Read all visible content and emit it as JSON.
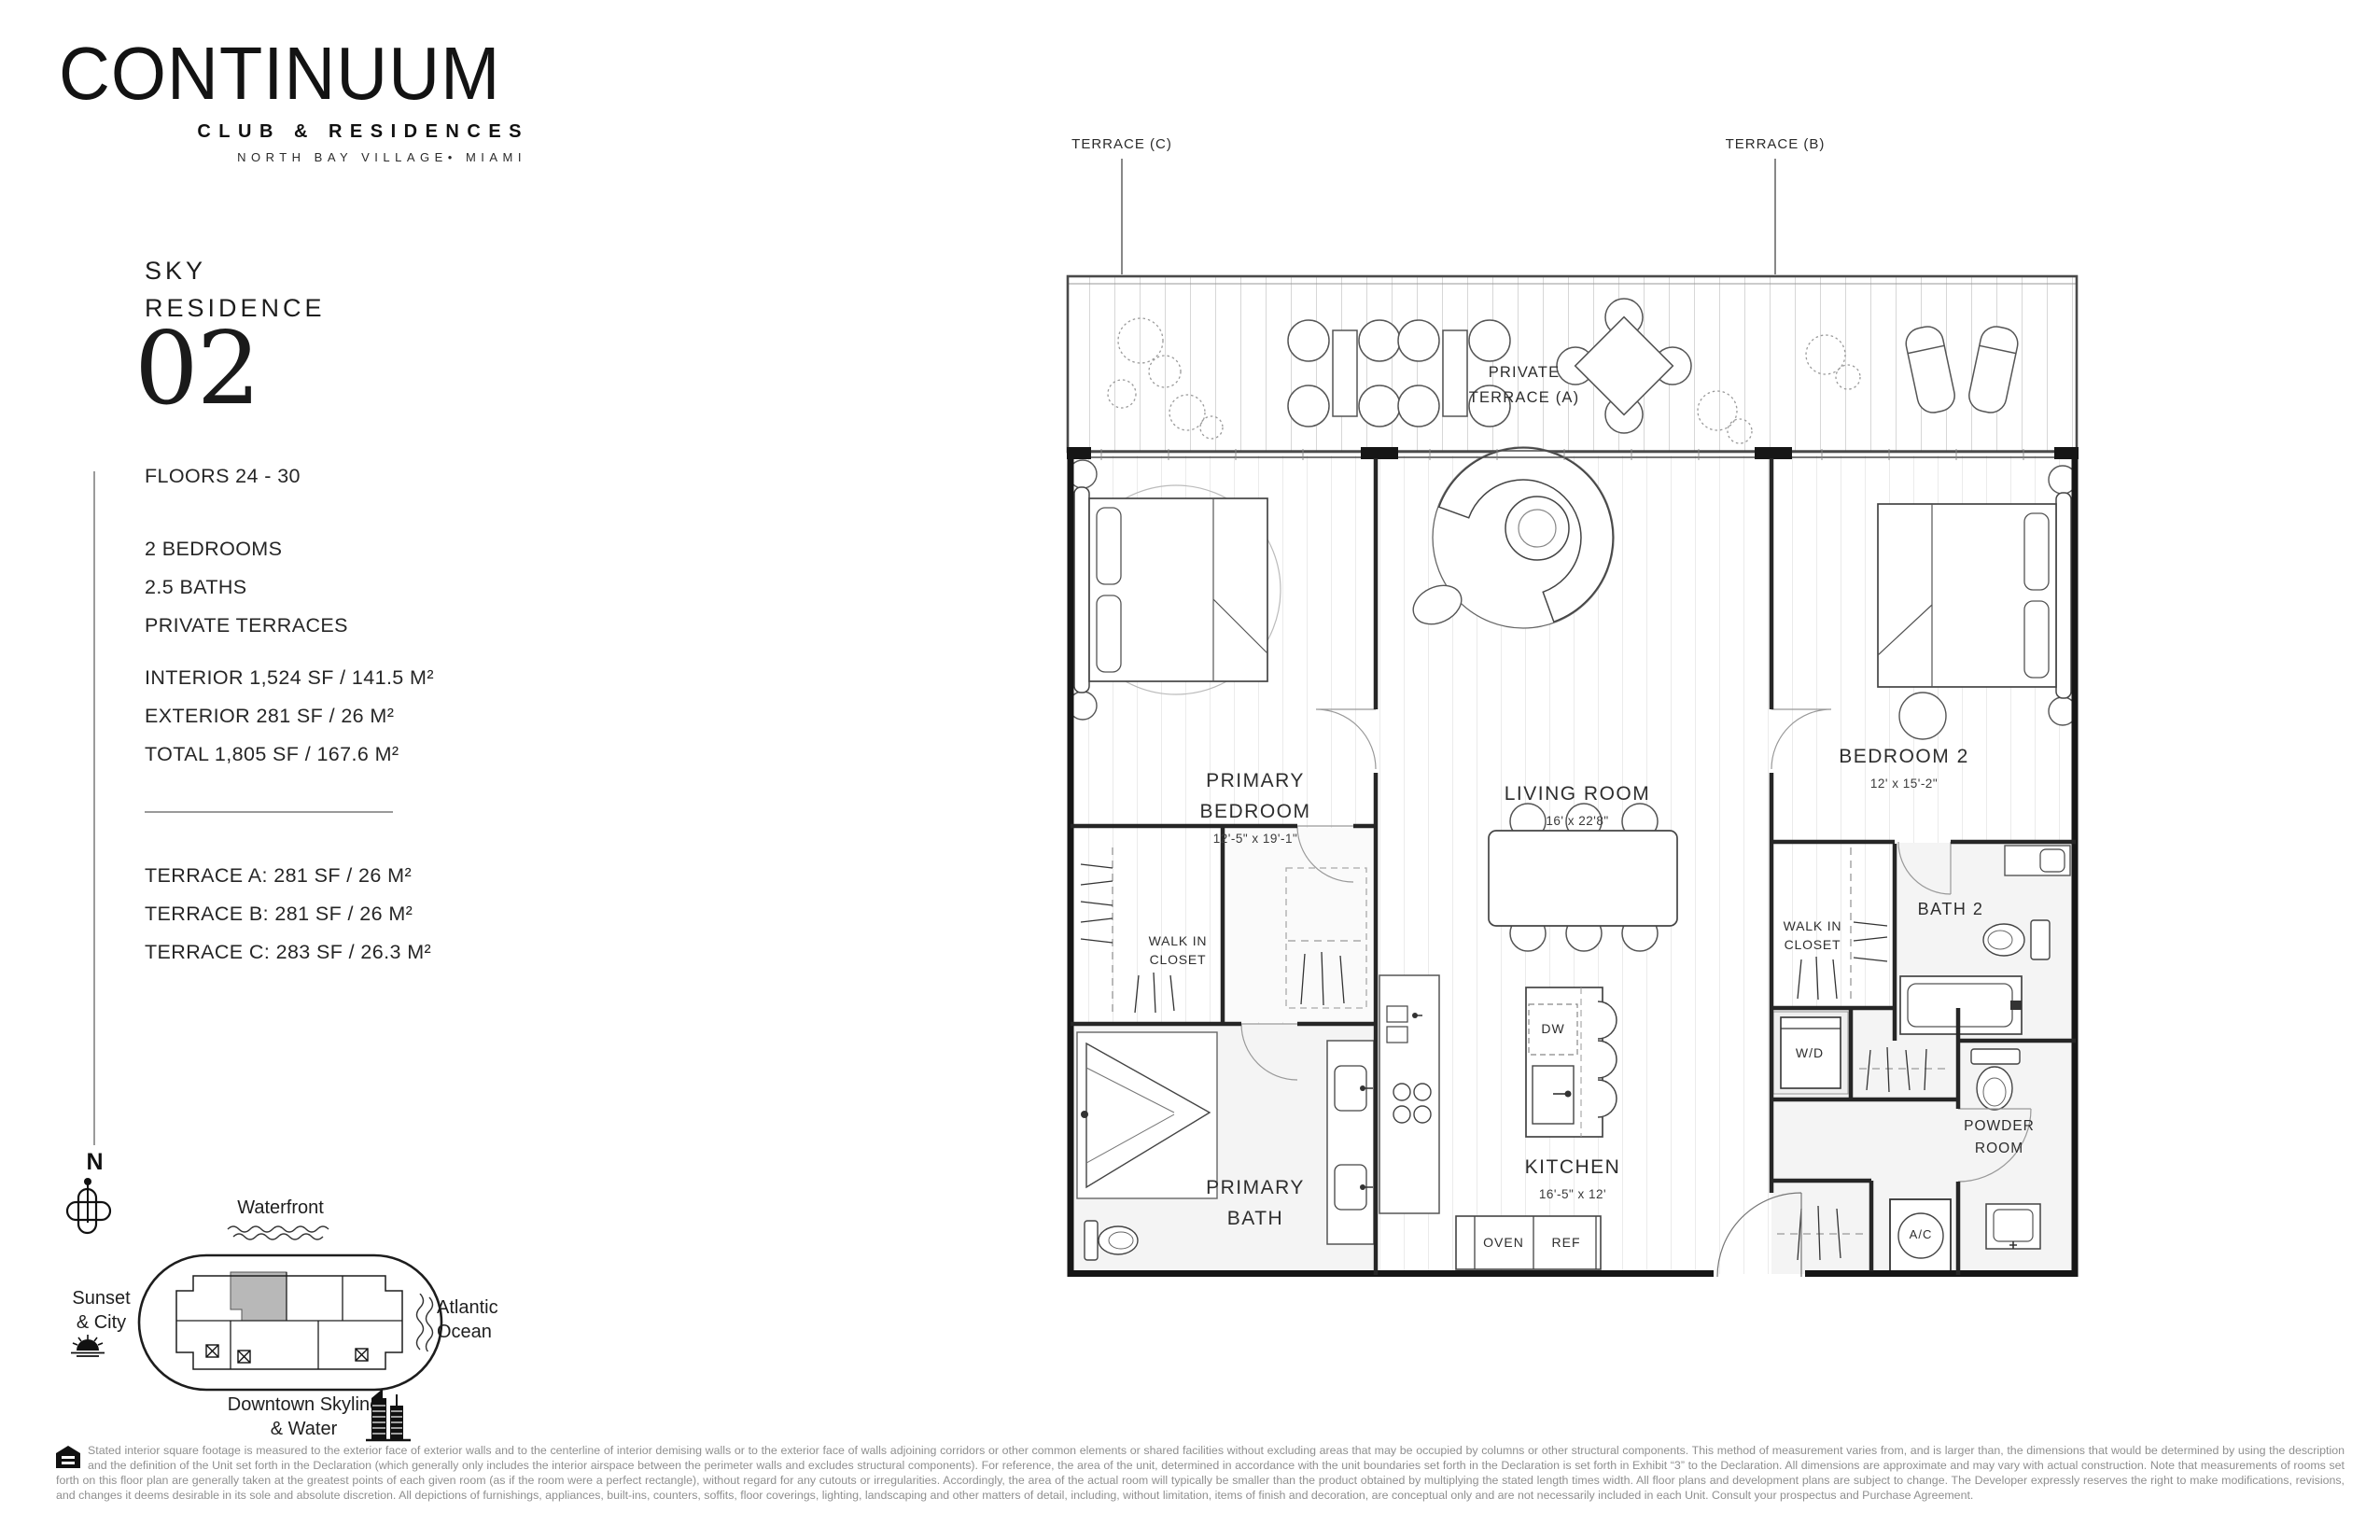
{
  "brand": {
    "name": "CONTINUUM",
    "tagline": "CLUB & RESIDENCES",
    "location": "NORTH BAY VILLAGE• MIAMI"
  },
  "residence": {
    "type_line1": "SKY",
    "type_line2": "RESIDENCE",
    "number": "02",
    "floors": "FLOORS 24 - 30",
    "features": [
      "2 BEDROOMS",
      "2.5 BATHS",
      "PRIVATE TERRACES"
    ],
    "areas": [
      "INTERIOR 1,524 SF / 141.5 M²",
      "EXTERIOR 281 SF / 26 M²",
      "TOTAL  1,805 SF / 167.6 M²"
    ],
    "terraces": [
      "TERRACE A: 281 SF / 26 M²",
      "TERRACE B: 281 SF / 26 M²",
      "TERRACE C: 283 SF / 26.3 M²"
    ]
  },
  "keyplan": {
    "north": "N",
    "waterfront": "Waterfront",
    "sunset_line1": "Sunset",
    "sunset_line2": "& City",
    "atlantic_line1": "Atlantic",
    "atlantic_line2": "Ocean",
    "downtown_line1": "Downtown Skyline",
    "downtown_line2": "& Water",
    "unit_highlight_color": "#b8b8b8"
  },
  "plan": {
    "terrace_c": "TERRACE (C)",
    "terrace_b": "TERRACE (B)",
    "private_terrace_line1": "PRIVATE",
    "private_terrace_line2": "TERRACE (A)",
    "primary_bedroom": {
      "line1": "PRIMARY",
      "line2": "BEDROOM",
      "dims": "12'-5\" x 19'-1\""
    },
    "living_room": {
      "name": "LIVING ROOM",
      "dims": "16' x 22'8\""
    },
    "bedroom2": {
      "name": "BEDROOM 2",
      "dims": "12' x 15'-2\""
    },
    "kitchen": {
      "name": "KITCHEN",
      "dims": "16'-5\" x 12'"
    },
    "primary_bath": {
      "line1": "PRIMARY",
      "line2": "BATH"
    },
    "walkin_left": {
      "line1": "WALK IN",
      "line2": "CLOSET"
    },
    "walkin_right": {
      "line1": "WALK IN",
      "line2": "CLOSET"
    },
    "bath2": "BATH 2",
    "powder": {
      "line1": "POWDER",
      "line2": "ROOM"
    },
    "wd": "W/D",
    "dw": "DW",
    "ac": "A/C",
    "oven": "OVEN",
    "ref": "REF"
  },
  "disclaimer": "Stated interior square footage is measured to the exterior face of exterior walls and to the centerline of interior demising walls or to the exterior face of walls adjoining corridors or other common elements or shared facilities without excluding areas that may be occupied by columns or other structural components. This method of measurement varies from, and is larger than, the dimensions that would be determined by using the description and the definition of the Unit set forth in the Declaration (which generally only includes the interior airspace between the perimeter walls and excludes structural components). For reference, the area of the unit, determined in accordance with the unit boundaries set forth in the Declaration is set forth in Exhibit “3” to the Declaration. All dimensions are approximate and may vary with actual construction. Note that measurements of rooms set forth on this floor plan are generally taken at the greatest points of each given room (as if the room were a perfect rectangle), without regard for any cutouts or irregularities. Accordingly, the area of the actual room will typically be smaller than the product obtained by multiplying the stated length times width. All floor plans and development plans are subject to change. The Developer expressly reserves the right to make modifications, revisions, and changes it deems desirable in its sole and absolute discretion. All depictions of furnishings, appliances, built-ins, counters, soffits, floor coverings, lighting, landscaping and other matters of detail, including, without limitation, items of finish and decoration, are conceptual only and are not necessarily included in each Unit. Consult your prospectus and Purchase Agreement."
}
